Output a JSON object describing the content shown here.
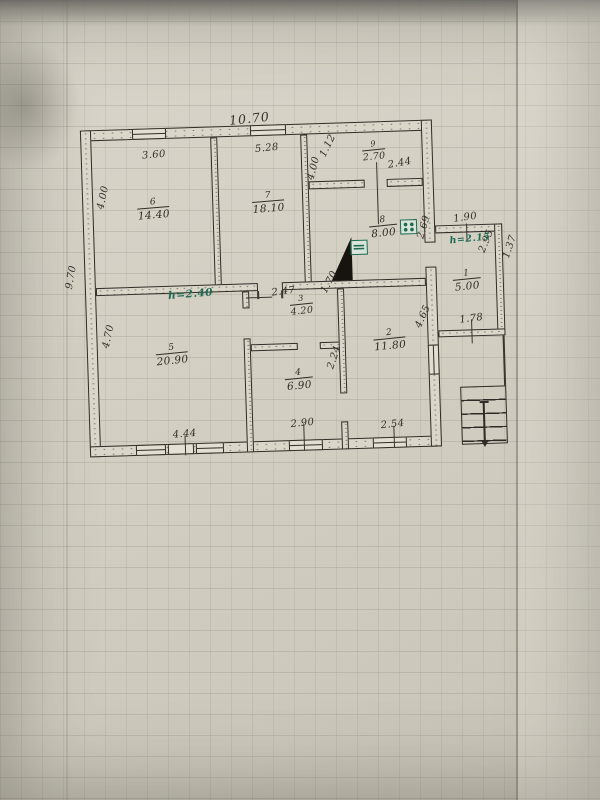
{
  "plan": {
    "rooms": {
      "r1": {
        "number": "1",
        "area": "5.00"
      },
      "r2": {
        "number": "2",
        "area": "11.80"
      },
      "r3": {
        "number": "3",
        "area": "4.20"
      },
      "r4": {
        "number": "4",
        "area": "6.90"
      },
      "r5": {
        "number": "5",
        "area": "20.90"
      },
      "r6": {
        "number": "6",
        "area": "14.40"
      },
      "r7": {
        "number": "7",
        "area": "18.10"
      },
      "r8": {
        "number": "8",
        "area": "8.00"
      },
      "r9": {
        "number": "9",
        "area": "2.70"
      }
    },
    "dimensions": {
      "top_total": "10.70",
      "left_total": "9.70",
      "room6_top": "3.60",
      "room6_left": "4.00",
      "room7_top": "5.28",
      "room7_right": "4.00",
      "room9_entry": "1.12",
      "room9_width": "2.44",
      "room8_right": "2.69",
      "room3_top": "2.47",
      "room3_right": "1.70",
      "room5_left": "4.70",
      "room5_bottom": "4.44",
      "room4_right": "2.24",
      "room4_bottom": "2.90",
      "room2_right": "4.65",
      "room2_bottom": "2.54",
      "annex_top": "1.90",
      "annex_inner": "2.95",
      "annex_right": "1.37",
      "annex_bottom": "1.78"
    },
    "annotations": {
      "main_height": "h=2.40",
      "annex_height": "h=2.15"
    },
    "colors": {
      "ink": "#34302a",
      "green_ink": "#1e6b52",
      "paper": "#d3cfc3"
    },
    "icons": {
      "stove": "stove-burners-icon",
      "heater": "heater-icon",
      "flue": "corner-flue-icon",
      "stairs": "entrance-stairs",
      "arrow": "down-arrow-icon"
    }
  }
}
